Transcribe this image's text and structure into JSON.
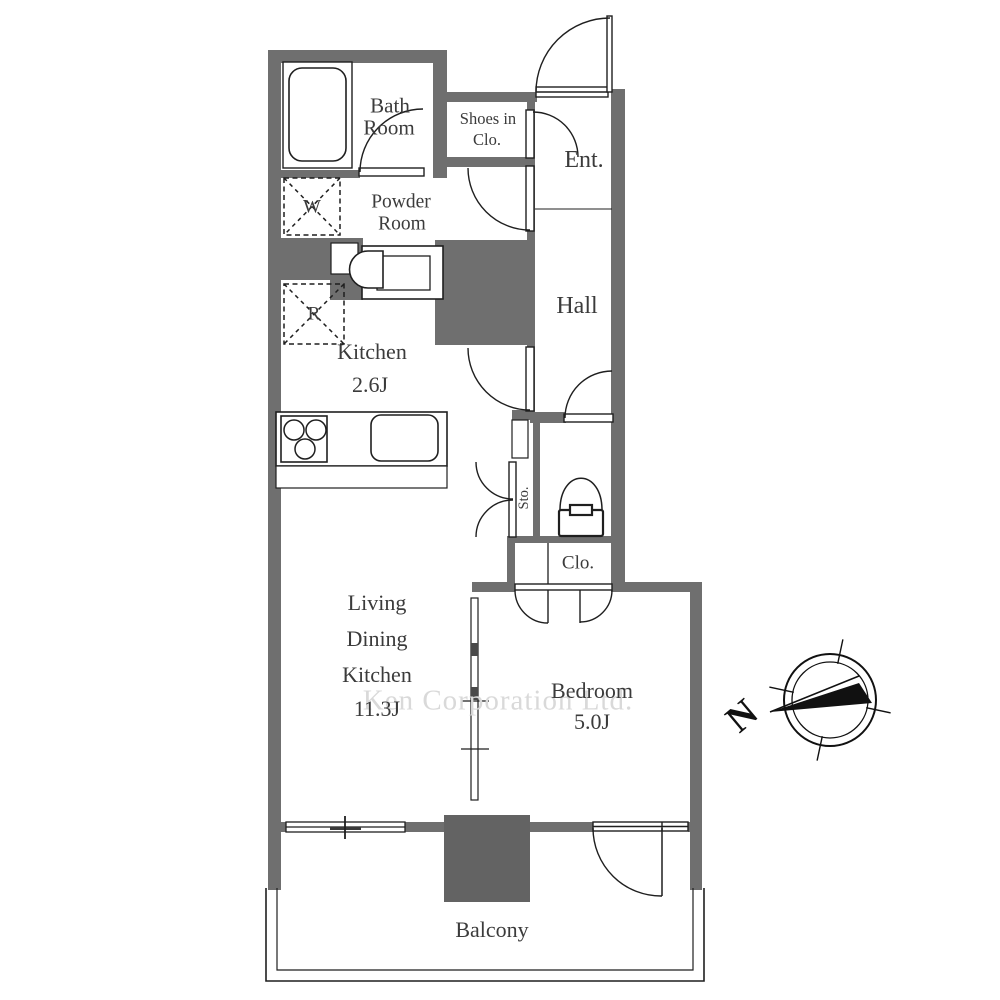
{
  "title": "Apartment floor plan",
  "watermark": "Ken Corporation Ltd.",
  "compass": {
    "north_label": "N"
  },
  "rooms": {
    "bath": {
      "line1": "Bath",
      "line2": "Room"
    },
    "shoes": {
      "line1": "Shoes in",
      "line2": "Clo."
    },
    "entrance": {
      "label": "Ent."
    },
    "powder": {
      "line1": "Powder",
      "line2": "Room"
    },
    "hall": {
      "label": "Hall"
    },
    "kitchen": {
      "name": "Kitchen",
      "size": "2.6J"
    },
    "storage": {
      "label": "Sto."
    },
    "closet": {
      "label": "Clo."
    },
    "ldk": {
      "line1": "Living",
      "line2": "Dining",
      "line3": "Kitchen",
      "size": "11.3J"
    },
    "bedroom": {
      "name": "Bedroom",
      "size": "5.0J"
    },
    "balcony": {
      "label": "Balcony"
    }
  },
  "markers": {
    "washing_machine": "W",
    "refrigerator": "R"
  },
  "colors": {
    "wall": "#6f6f6f",
    "pillar": "#636363",
    "line": "#1f1f1f",
    "text": "#3b3b3b",
    "watermark": "#d9d9d9"
  }
}
